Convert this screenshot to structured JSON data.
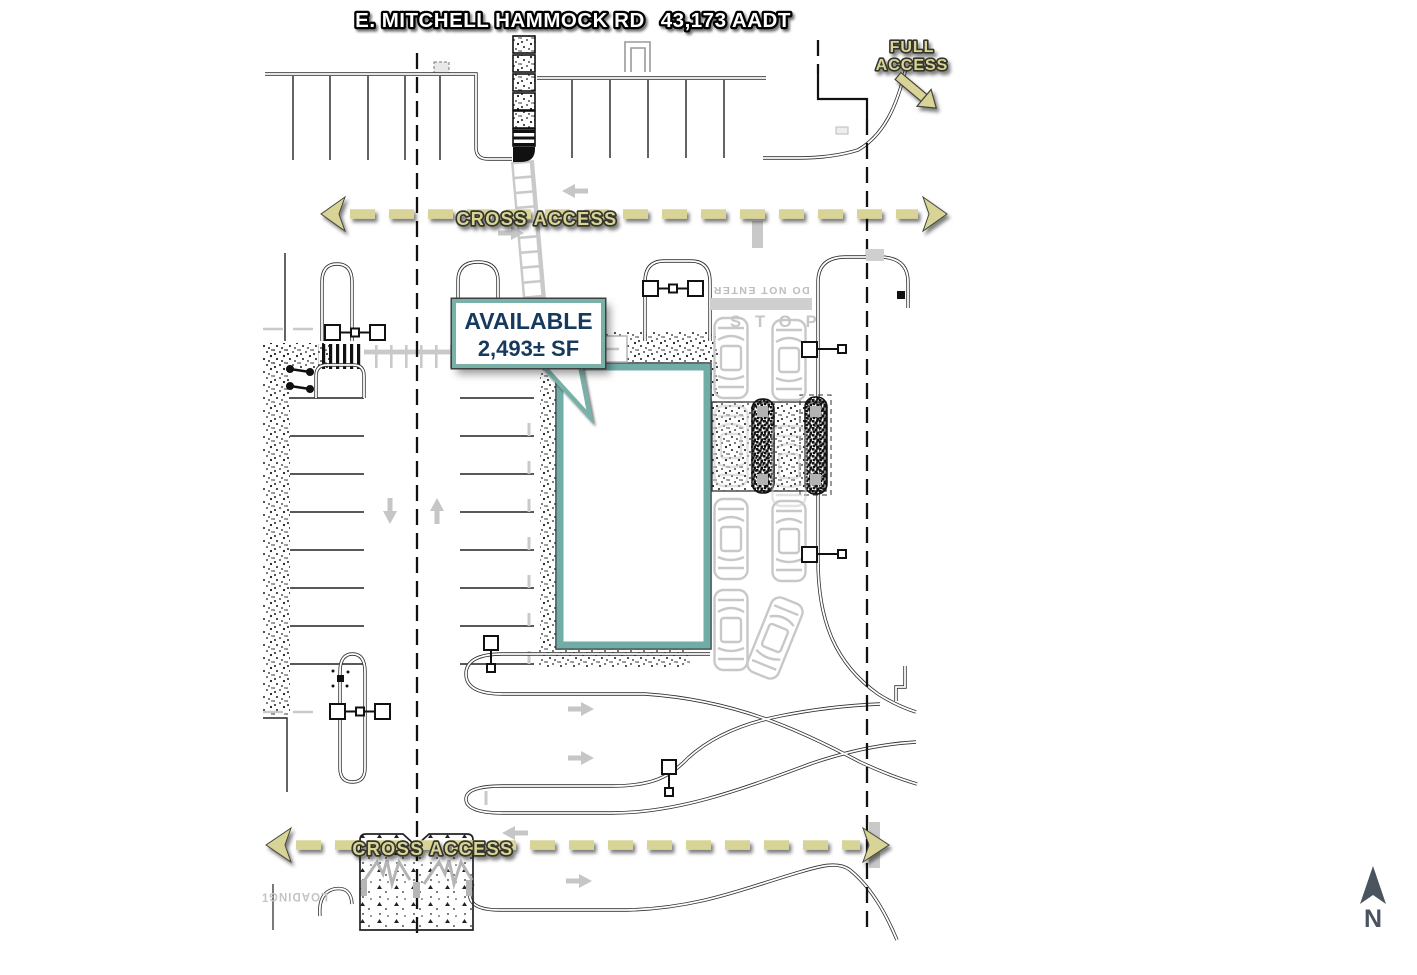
{
  "title": {
    "road_name": "E. MITCHELL HAMMOCK RD",
    "traffic_count": "43,173 AADT"
  },
  "access_labels": {
    "full_access_line1": "FULL",
    "full_access_line2": "ACCESS",
    "cross_access_top": "CROSS ACCESS",
    "cross_access_bottom": "CROSS ACCESS"
  },
  "callout": {
    "availability": "AVAILABLE",
    "size": "2,493± SF"
  },
  "site_text": {
    "stop": "STOP",
    "do_not_enter": "DO NOT ENTER",
    "loading": "LOADING",
    "loading_space_number": "1"
  },
  "compass": {
    "north_label": "N"
  },
  "colors": {
    "khaki_accent": "#d8d396",
    "teal_accent": "#79b1a9",
    "navy_text": "#16395e",
    "linework_dark": "#2f2f2f",
    "gray_linework": "#c8c8c8",
    "north_arrow": "#4a545e"
  }
}
